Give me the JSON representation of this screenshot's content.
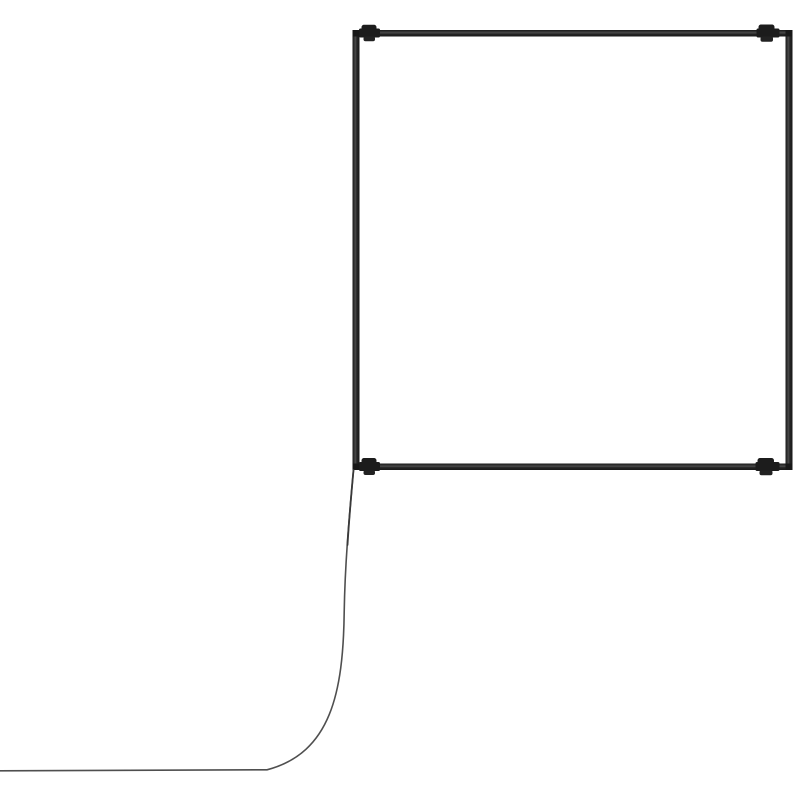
{
  "scene": {
    "description": "3D product render of a square tubular frame (light fixture / extrusion) with four small clamp connectors near the corners and a thin power cable hanging from the bottom-left corner, curving down and running to the left edge of the image",
    "background_color": "#ffffff",
    "frame": {
      "edge_color": "#181818",
      "highlight_color": "#4a4a4a",
      "base_color": "#262626",
      "connector_color": "#1c1c1c",
      "connector_lower_color": "#222222"
    },
    "cable": {
      "color": "#4f4f4f",
      "tip_color": "#3a3a3a"
    }
  }
}
